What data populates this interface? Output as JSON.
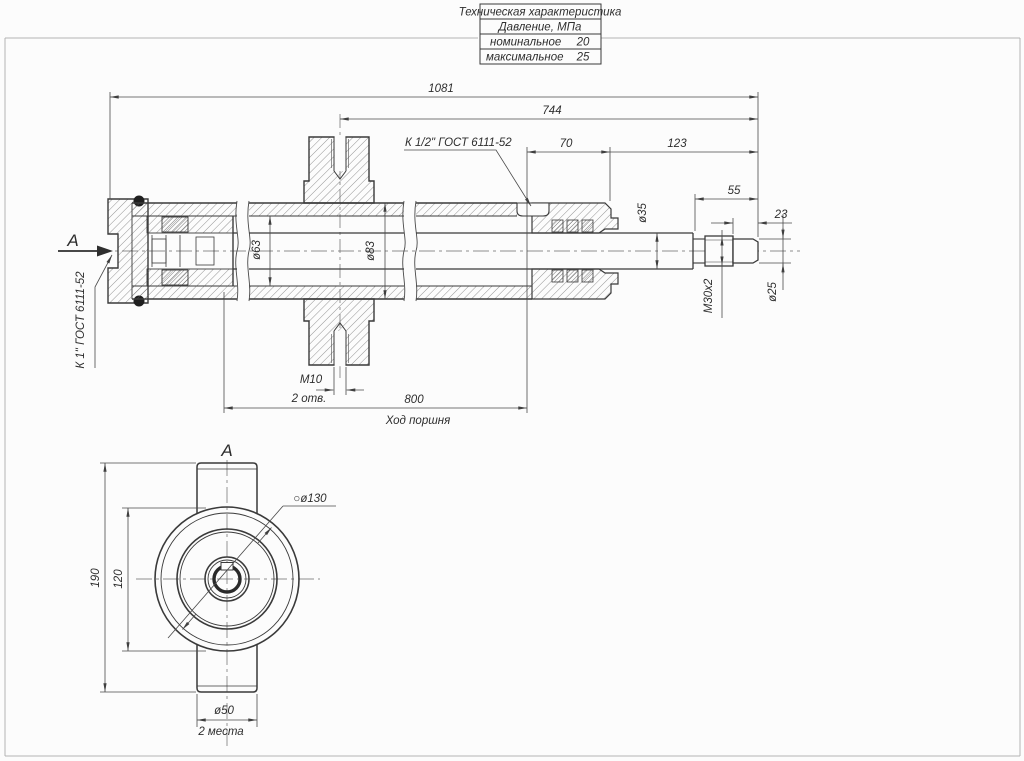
{
  "sheet": {
    "table": {
      "title": "Техническая характеристика",
      "group": "Давление, МПа",
      "rows": [
        {
          "label": "номинальное",
          "value": "20"
        },
        {
          "label": "максимальное",
          "value": "25"
        }
      ]
    }
  },
  "main_view": {
    "section_letter": "А",
    "port_left_label": "К 1\" ГОСТ 6111-52",
    "port_right_label": "К 1/2\" ГОСТ 6111-52",
    "dims": {
      "total_length": "1081",
      "axis_to_end": "744",
      "gland_span": "70",
      "rod_extension": "123",
      "rod_end_length": "55",
      "tip_length": "23",
      "rod_diameter": "ø35",
      "bore_diameter": "ø63",
      "tube_diameter": "ø83",
      "rod_thread": "M30x2",
      "tip_diameter": "ø25",
      "boss_thread": "М10",
      "boss_holes_note": "2 отв.",
      "piston_stroke": "800",
      "piston_stroke_label": "Ход поршня"
    }
  },
  "section_view": {
    "section_letter": "А",
    "dims": {
      "flange_diameter": "○ø130",
      "overall_height": "190",
      "body_diameter": "120",
      "boss_diameter": "ø50",
      "boss_places_note": "2 места"
    }
  }
}
